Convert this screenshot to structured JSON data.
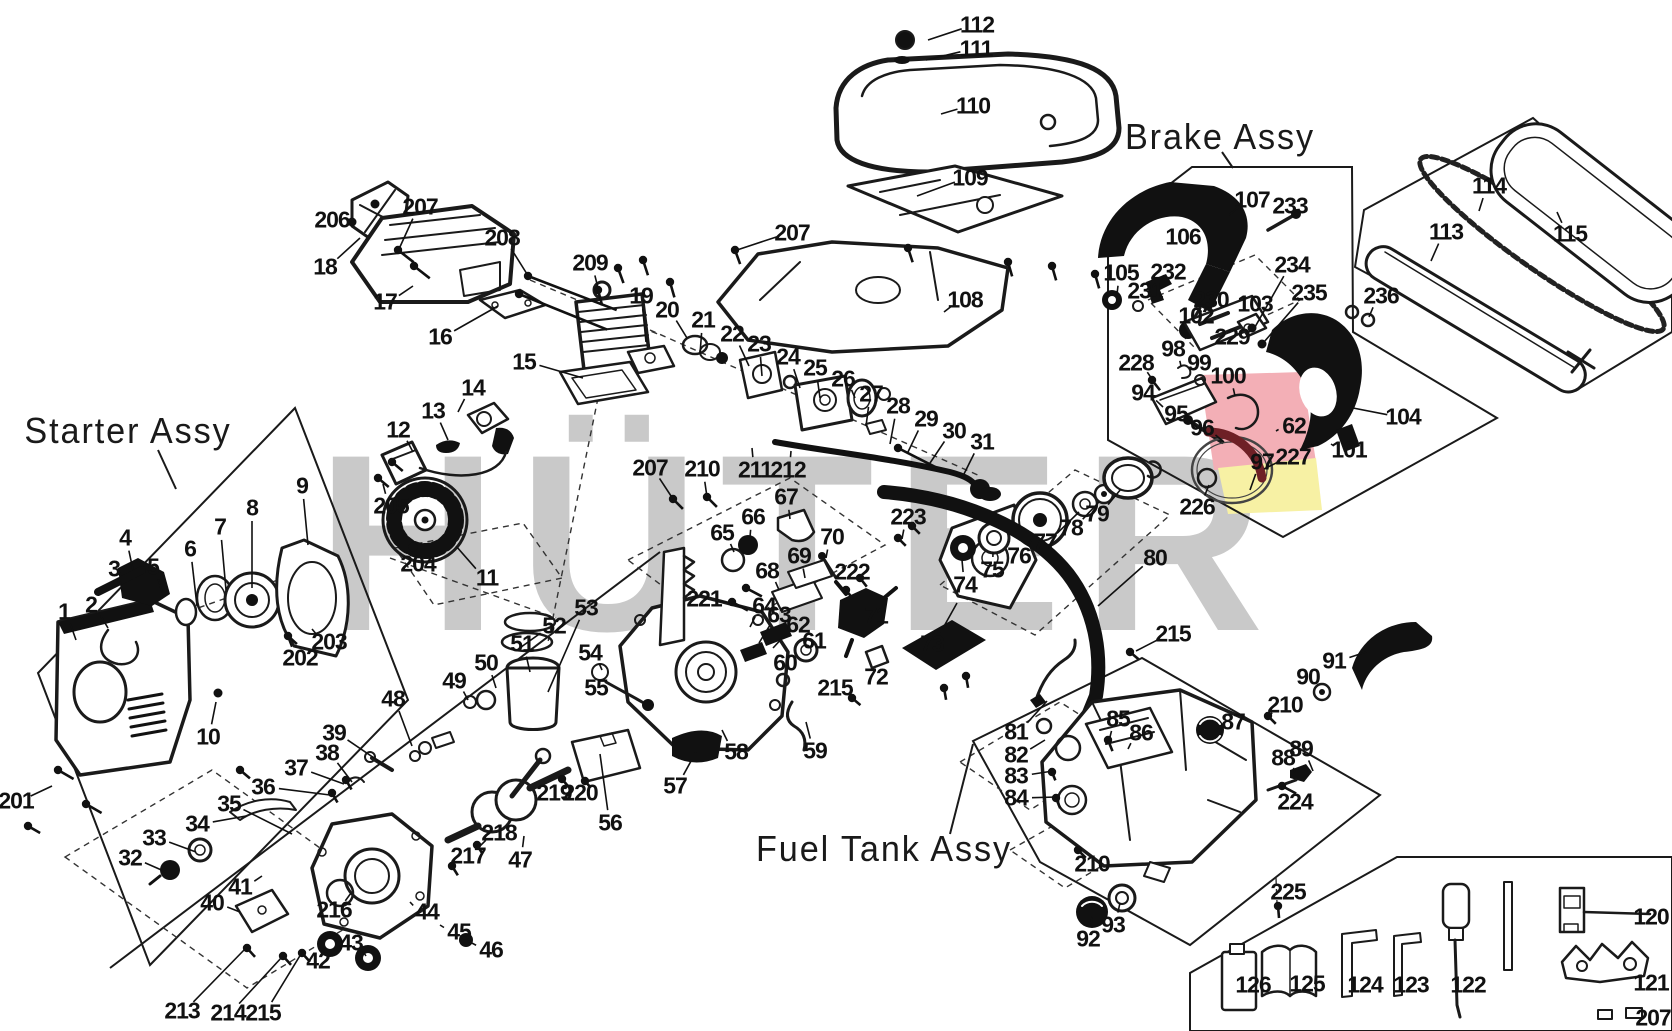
{
  "diagram": {
    "watermark": {
      "text": "HÜTER",
      "color": "#c9c9c9",
      "accents": {
        "pink": "#f3afb6",
        "yellow": "#f7f1a4",
        "dark_red": "#6e2026"
      }
    },
    "assembly_labels": [
      {
        "id": "starter",
        "label": "Starter Assy",
        "x": 128,
        "y": 431,
        "leader": [
          158,
          450,
          176,
          489
        ]
      },
      {
        "id": "brake",
        "label": "Brake Assy",
        "x": 1220,
        "y": 137,
        "leader": [
          1222,
          152,
          1233,
          168
        ]
      },
      {
        "id": "fuel",
        "label": "Fuel Tank Assy",
        "x": 884,
        "y": 849,
        "leader": [
          950,
          834,
          973,
          744
        ]
      }
    ],
    "callouts": [
      [
        "1",
        64,
        612,
        76,
        640
      ],
      [
        "2",
        91,
        605,
        108,
        628
      ],
      [
        "3",
        114,
        569,
        123,
        592
      ],
      [
        "4",
        125,
        538,
        133,
        570
      ],
      [
        "5",
        153,
        567,
        162,
        592
      ],
      [
        "6",
        190,
        549,
        197,
        606
      ],
      [
        "7",
        220,
        527,
        226,
        590
      ],
      [
        "8",
        252,
        508,
        252,
        588
      ],
      [
        "9",
        302,
        486,
        308,
        545
      ],
      [
        "10",
        208,
        737,
        216,
        702
      ],
      [
        "11",
        487,
        578,
        456,
        546
      ],
      [
        "12",
        398,
        430,
        413,
        452
      ],
      [
        "13",
        433,
        411,
        448,
        440
      ],
      [
        "14",
        473,
        388,
        458,
        412
      ],
      [
        "15",
        524,
        362,
        583,
        378
      ],
      [
        "16",
        440,
        337,
        498,
        306
      ],
      [
        "17",
        385,
        302,
        413,
        286
      ],
      [
        "18",
        325,
        267,
        360,
        238
      ],
      [
        "19",
        641,
        296,
        646,
        342
      ],
      [
        "20",
        667,
        310,
        687,
        338
      ],
      [
        "21",
        703,
        320,
        700,
        354
      ],
      [
        "22",
        732,
        334,
        749,
        366
      ],
      [
        "23",
        759,
        344,
        762,
        376
      ],
      [
        "24",
        788,
        357,
        800,
        388
      ],
      [
        "25",
        815,
        368,
        820,
        398
      ],
      [
        "26",
        843,
        379,
        855,
        398
      ],
      [
        "27",
        871,
        394,
        866,
        426
      ],
      [
        "28",
        898,
        406,
        890,
        444
      ],
      [
        "29",
        926,
        419,
        908,
        452
      ],
      [
        "30",
        954,
        431,
        928,
        466
      ],
      [
        "31",
        982,
        442,
        962,
        478
      ],
      [
        "32",
        130,
        858,
        166,
        872
      ],
      [
        "33",
        154,
        838,
        196,
        852
      ],
      [
        "34",
        197,
        824,
        246,
        816
      ],
      [
        "35",
        229,
        804,
        292,
        834
      ],
      [
        "36",
        263,
        787,
        330,
        795
      ],
      [
        "37",
        296,
        768,
        344,
        784
      ],
      [
        "38",
        327,
        753,
        352,
        782
      ],
      [
        "39",
        334,
        733,
        380,
        762
      ],
      [
        "40",
        212,
        903,
        240,
        912
      ],
      [
        "41",
        240,
        887,
        262,
        876
      ],
      [
        "42",
        318,
        961,
        330,
        948
      ],
      [
        "43",
        351,
        943,
        366,
        956
      ],
      [
        "44",
        427,
        912,
        410,
        902
      ],
      [
        "45",
        459,
        932,
        440,
        925
      ],
      [
        "46",
        491,
        950,
        468,
        941
      ],
      [
        "47",
        520,
        860,
        524,
        836
      ],
      [
        "48",
        393,
        699,
        412,
        746
      ],
      [
        "49",
        454,
        681,
        468,
        700
      ],
      [
        "50",
        486,
        663,
        496,
        688
      ],
      [
        "51",
        522,
        644,
        530,
        672
      ],
      [
        "52",
        554,
        626,
        517,
        650
      ],
      [
        "53",
        586,
        608,
        548,
        692
      ],
      [
        "54",
        590,
        653,
        602,
        670
      ],
      [
        "55",
        596,
        688,
        612,
        696
      ],
      [
        "56",
        610,
        823,
        600,
        754
      ],
      [
        "57",
        675,
        786,
        696,
        752
      ],
      [
        "58",
        736,
        752,
        722,
        730
      ],
      [
        "59",
        815,
        751,
        806,
        722
      ],
      [
        "60",
        785,
        663,
        783,
        676
      ],
      [
        "61",
        814,
        641,
        801,
        652
      ],
      [
        "62",
        798,
        625,
        773,
        648
      ],
      [
        "63",
        779,
        615,
        759,
        643
      ],
      [
        "64",
        764,
        606,
        750,
        627
      ],
      [
        "65",
        722,
        533,
        734,
        552
      ],
      [
        "66",
        753,
        517,
        750,
        537
      ],
      [
        "67",
        786,
        497,
        790,
        519
      ],
      [
        "68",
        767,
        571,
        779,
        590
      ],
      [
        "69",
        799,
        556,
        805,
        578
      ],
      [
        "70",
        832,
        537,
        826,
        558
      ],
      [
        "71",
        876,
        616,
        864,
        620
      ],
      [
        "72",
        876,
        677,
        875,
        661
      ],
      [
        "73",
        932,
        644,
        957,
        603
      ],
      [
        "74",
        965,
        585,
        962,
        560
      ],
      [
        "75",
        992,
        570,
        993,
        552
      ],
      [
        "76",
        1019,
        556,
        1035,
        534
      ],
      [
        "77",
        1045,
        542,
        1079,
        512
      ],
      [
        "78",
        1071,
        528,
        1099,
        502
      ],
      [
        "79",
        1097,
        514,
        1121,
        489
      ],
      [
        "80",
        1155,
        558,
        1098,
        606
      ],
      [
        "81",
        1016,
        732,
        1047,
        701
      ],
      [
        "82",
        1016,
        755,
        1045,
        740
      ],
      [
        "83",
        1016,
        776,
        1053,
        771
      ],
      [
        "84",
        1016,
        798,
        1057,
        797
      ],
      [
        "85",
        1118,
        719,
        1110,
        737
      ],
      [
        "86",
        1141,
        733,
        1128,
        749
      ],
      [
        "87",
        1233,
        722,
        1216,
        730
      ],
      [
        "88",
        1283,
        758,
        1295,
        772
      ],
      [
        "89",
        1301,
        749,
        1313,
        771
      ],
      [
        "90",
        1308,
        677,
        1320,
        690
      ],
      [
        "91",
        1334,
        661,
        1366,
        652
      ],
      [
        "92",
        1088,
        939,
        1092,
        917
      ],
      [
        "93",
        1113,
        925,
        1120,
        903
      ],
      [
        "94",
        1143,
        393,
        1163,
        407
      ],
      [
        "95",
        1176,
        414,
        1197,
        427
      ],
      [
        "96",
        1202,
        428,
        1224,
        442
      ],
      [
        "97",
        1262,
        462,
        1250,
        490
      ],
      [
        "98",
        1173,
        349,
        1181,
        366
      ],
      [
        "99",
        1199,
        363,
        1204,
        376
      ],
      [
        "100",
        1228,
        376,
        1235,
        396
      ],
      [
        "101",
        1349,
        450,
        1331,
        444
      ],
      [
        "102",
        1196,
        316,
        1190,
        324
      ],
      [
        "103",
        1255,
        304,
        1247,
        317
      ],
      [
        "104",
        1403,
        417,
        1353,
        408
      ],
      [
        "105",
        1121,
        273,
        1117,
        294
      ],
      [
        "106",
        1183,
        237,
        1178,
        222
      ],
      [
        "107",
        1252,
        200,
        1229,
        215
      ],
      [
        "108",
        965,
        300,
        944,
        312
      ],
      [
        "109",
        970,
        178,
        917,
        196
      ],
      [
        "110",
        973,
        106,
        941,
        114
      ],
      [
        "111",
        976,
        49,
        926,
        60
      ],
      [
        "112",
        977,
        25,
        928,
        40
      ],
      [
        "113",
        1446,
        232,
        1431,
        261
      ],
      [
        "114",
        1489,
        186,
        1479,
        211
      ],
      [
        "115",
        1570,
        234,
        1557,
        212
      ],
      [
        "120",
        1651,
        917,
        1641,
        914
      ],
      [
        "121",
        1651,
        983,
        1641,
        972
      ],
      [
        "122",
        1468,
        985,
        1459,
        982
      ],
      [
        "123",
        1411,
        985,
        1405,
        982
      ],
      [
        "124",
        1365,
        985,
        1355,
        982
      ],
      [
        "125",
        1307,
        984,
        1295,
        981
      ],
      [
        "126",
        1253,
        985,
        1244,
        982
      ],
      [
        "201",
        16,
        801,
        52,
        786
      ],
      [
        "202",
        300,
        658,
        289,
        640
      ],
      [
        "203",
        329,
        642,
        312,
        629
      ],
      [
        "204",
        418,
        564,
        414,
        550
      ],
      [
        "205",
        391,
        506,
        383,
        484
      ],
      [
        "206",
        332,
        220,
        350,
        222
      ],
      [
        "207",
        420,
        207,
        399,
        249
      ],
      [
        "207",
        792,
        233,
        737,
        250
      ],
      [
        "207",
        650,
        468,
        673,
        499
      ],
      [
        "207",
        1653,
        1018,
        1643,
        1014
      ],
      [
        "208",
        502,
        238,
        527,
        274
      ],
      [
        "209",
        590,
        263,
        598,
        288
      ],
      [
        "210",
        702,
        469,
        707,
        497
      ],
      [
        "210",
        1285,
        705,
        1270,
        716
      ],
      [
        "210",
        1092,
        864,
        1080,
        851
      ],
      [
        "211",
        755,
        470,
        752,
        448
      ],
      [
        "212",
        788,
        470,
        791,
        451
      ],
      [
        "213",
        182,
        1011,
        245,
        949
      ],
      [
        "214",
        228,
        1013,
        282,
        957
      ],
      [
        "215",
        263,
        1013,
        301,
        954
      ],
      [
        "215",
        835,
        688,
        851,
        697
      ],
      [
        "215",
        1173,
        634,
        1136,
        651
      ],
      [
        "216",
        334,
        910,
        351,
        893
      ],
      [
        "217",
        468,
        856,
        455,
        867
      ],
      [
        "218",
        499,
        833,
        480,
        846
      ],
      [
        "219",
        554,
        793,
        562,
        781
      ],
      [
        "220",
        580,
        793,
        586,
        783
      ],
      [
        "221",
        704,
        599,
        729,
        603
      ],
      [
        "222",
        852,
        572,
        850,
        589
      ],
      [
        "223",
        908,
        517,
        902,
        539
      ],
      [
        "224",
        1295,
        802,
        1285,
        791
      ],
      [
        "225",
        1288,
        892,
        1280,
        905
      ],
      [
        "226",
        1197,
        507,
        1209,
        485
      ],
      [
        "227",
        1293,
        457,
        1264,
        469
      ],
      [
        "228",
        1136,
        363,
        1152,
        379
      ],
      [
        "229",
        1232,
        337,
        1221,
        343
      ],
      [
        "230",
        1211,
        300,
        1199,
        316
      ],
      [
        "231",
        1145,
        291,
        1140,
        303
      ],
      [
        "232",
        1168,
        272,
        1160,
        286
      ],
      [
        "233",
        1290,
        206,
        1283,
        221
      ],
      [
        "234",
        1292,
        265,
        1255,
        327
      ],
      [
        "235",
        1309,
        293,
        1264,
        342
      ],
      [
        "236",
        1381,
        296,
        1369,
        317
      ],
      [
        "62",
        1294,
        426,
        1276,
        431
      ]
    ],
    "screws": [
      [
        352,
        222,
        0,
        0
      ],
      [
        375,
        204,
        0,
        0
      ],
      [
        398,
        250,
        38,
        20
      ],
      [
        414,
        266,
        38,
        20
      ],
      [
        528,
        276,
        21,
        95
      ],
      [
        519,
        294,
        22,
        95
      ],
      [
        598,
        290,
        75,
        16
      ],
      [
        618,
        268,
        70,
        16
      ],
      [
        643,
        260,
        72,
        16
      ],
      [
        670,
        282,
        74,
        16
      ],
      [
        735,
        250,
        70,
        15
      ],
      [
        908,
        248,
        72,
        15
      ],
      [
        1008,
        262,
        74,
        15
      ],
      [
        1052,
        266,
        74,
        15
      ],
      [
        1095,
        274,
        74,
        15
      ],
      [
        673,
        499,
        45,
        14
      ],
      [
        707,
        497,
        45,
        14
      ],
      [
        378,
        478,
        40,
        14
      ],
      [
        392,
        462,
        40,
        14
      ],
      [
        413,
        547,
        0,
        0
      ],
      [
        58,
        770,
        30,
        18
      ],
      [
        86,
        804,
        30,
        18
      ],
      [
        28,
        826,
        30,
        14
      ],
      [
        288,
        636,
        42,
        12
      ],
      [
        240,
        770,
        40,
        13
      ],
      [
        332,
        793,
        60,
        11
      ],
      [
        346,
        780,
        60,
        11
      ],
      [
        247,
        948,
        48,
        12
      ],
      [
        283,
        956,
        48,
        12
      ],
      [
        302,
        953,
        48,
        12
      ],
      [
        452,
        866,
        58,
        11
      ],
      [
        477,
        845,
        58,
        10
      ],
      [
        562,
        779,
        50,
        9
      ],
      [
        585,
        781,
        50,
        9
      ],
      [
        732,
        602,
        28,
        18
      ],
      [
        746,
        588,
        28,
        18
      ],
      [
        846,
        590,
        52,
        11
      ],
      [
        860,
        578,
        52,
        11
      ],
      [
        898,
        538,
        45,
        11
      ],
      [
        912,
        526,
        45,
        11
      ],
      [
        944,
        688,
        80,
        12
      ],
      [
        966,
        676,
        80,
        12
      ],
      [
        1152,
        380,
        52,
        13
      ],
      [
        1252,
        328,
        0,
        0
      ],
      [
        1262,
        344,
        0,
        0
      ],
      [
        1268,
        716,
        45,
        11
      ],
      [
        1078,
        850,
        45,
        11
      ],
      [
        1130,
        652,
        40,
        11
      ],
      [
        852,
        698,
        40,
        11
      ],
      [
        1108,
        740,
        68,
        12
      ],
      [
        1052,
        772,
        68,
        9
      ],
      [
        1056,
        798,
        68,
        11
      ],
      [
        1282,
        786,
        28,
        16
      ],
      [
        898,
        448,
        27,
        48
      ],
      [
        1278,
        906,
        85,
        12
      ],
      [
        218,
        693,
        0,
        0
      ]
    ]
  }
}
